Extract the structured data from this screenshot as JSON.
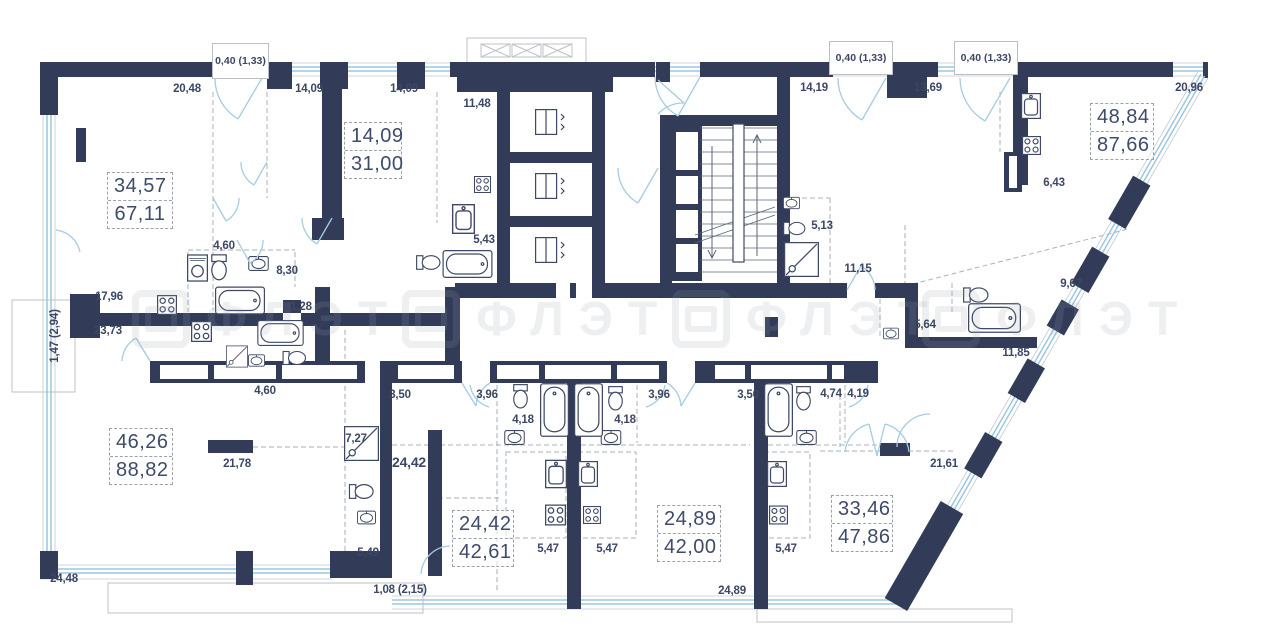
{
  "watermark": {
    "text": "ФЛЭТ"
  },
  "top_dims": {
    "win1": "0,40 (1,33)",
    "win2": "0,40 (1,33)",
    "win3": "0,40 (1,33)",
    "w1": "20,48",
    "w2": "14,09",
    "w3": "14,09",
    "w4": "11,48",
    "w5": "14,19",
    "w6": "13,69",
    "w7": "20,96"
  },
  "apartments": {
    "a1": {
      "living": "34,57",
      "total": "67,11"
    },
    "a2": {
      "living": "14,09",
      "total": "31,00"
    },
    "a3": {
      "living": "48,84",
      "total": "87,66"
    },
    "a4": {
      "living": "46,26",
      "total": "88,82"
    },
    "a5": {
      "living": "24,42",
      "total": "42,61"
    },
    "a6": {
      "living": "24,89",
      "total": "42,00"
    },
    "a7": {
      "living": "33,46",
      "total": "47,86"
    }
  },
  "interior_dims": {
    "kitchen_top": "17,96",
    "kitchen_bottom": "23,73",
    "balcony_left": "1,47 (2,94)",
    "wc1": "4,60",
    "bath1": "8,30",
    "door1": "1,28",
    "bath2": "5,43",
    "wc2": "5,13",
    "hall2": "11,15",
    "bath3": "9,67",
    "kit3": "6,43",
    "nook": "5,64",
    "hall3": "11,85",
    "wc4": "4,60",
    "room4": "21,78",
    "wc5": "7,27",
    "top5": "24,42",
    "b1": "3,50",
    "b2": "3,96",
    "b3": "4,18",
    "b4": "4,18",
    "b5": "3,96",
    "b6": "3,50",
    "b7": "4,74",
    "b8": "4,19",
    "hall7": "21,61",
    "bath4": "5,49",
    "kit5": "5,47",
    "kit6": "5,47",
    "kit7": "5,47",
    "bottom_left": "24,48",
    "bottom_step": "1,08 (2,15)",
    "bottom_mid": "24,89"
  }
}
